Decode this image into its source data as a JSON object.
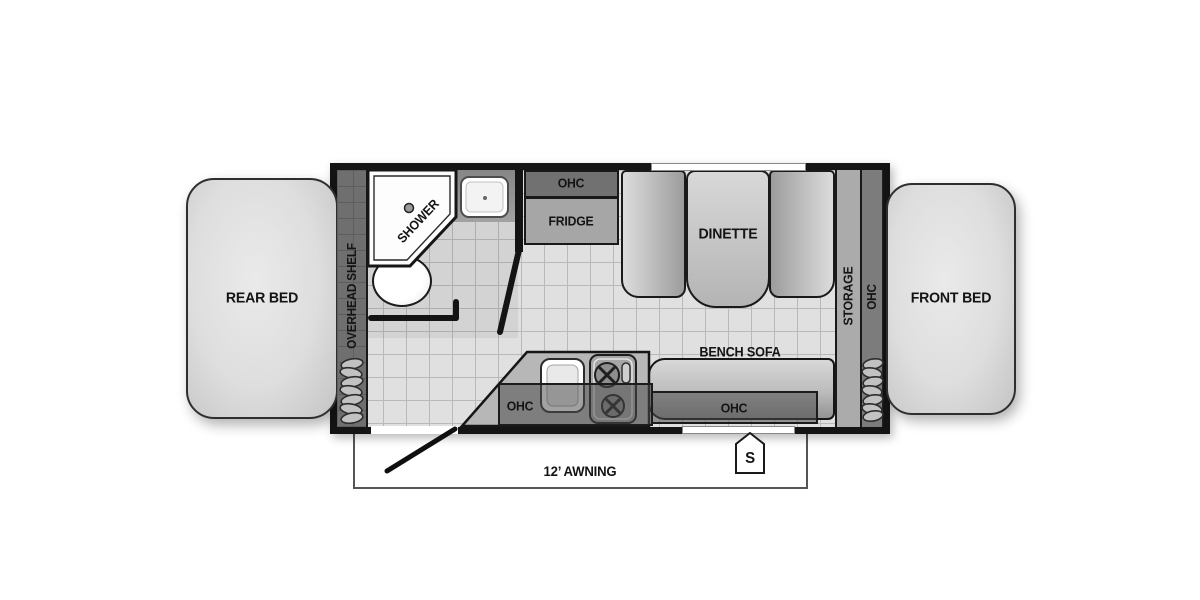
{
  "plan": {
    "rear_bed": {
      "label": "REAR BED"
    },
    "front_bed": {
      "label": "FRONT BED"
    },
    "overhead_shelf": {
      "label": "OVERHEAD SHELF"
    },
    "bathroom": {
      "shower": {
        "label": "SHOWER"
      }
    },
    "kitchen": {
      "ohc_top": {
        "label": "OHC"
      },
      "fridge": {
        "label": "FRIDGE"
      },
      "counter_ohc": {
        "label": "OHC"
      }
    },
    "dinette": {
      "label": "DINETTE"
    },
    "storage": {
      "label": "STORAGE"
    },
    "front_ohc": {
      "label": "OHC"
    },
    "bench_sofa": {
      "label": "BENCH SOFA",
      "ohc": {
        "label": "OHC"
      }
    },
    "awning": {
      "label": "12’ AWNING"
    },
    "badge": {
      "label": "S"
    }
  },
  "colors": {
    "wall": "#141414",
    "floor_tile": "#e0e0e0",
    "tile_grid": "#b9b9b9",
    "cabinet_dark": "#717171",
    "cabinet_light": "#a6a6a6",
    "furniture_gray": "#bdbdbd",
    "fixture_white": "#ffffff",
    "background": "#ffffff"
  }
}
